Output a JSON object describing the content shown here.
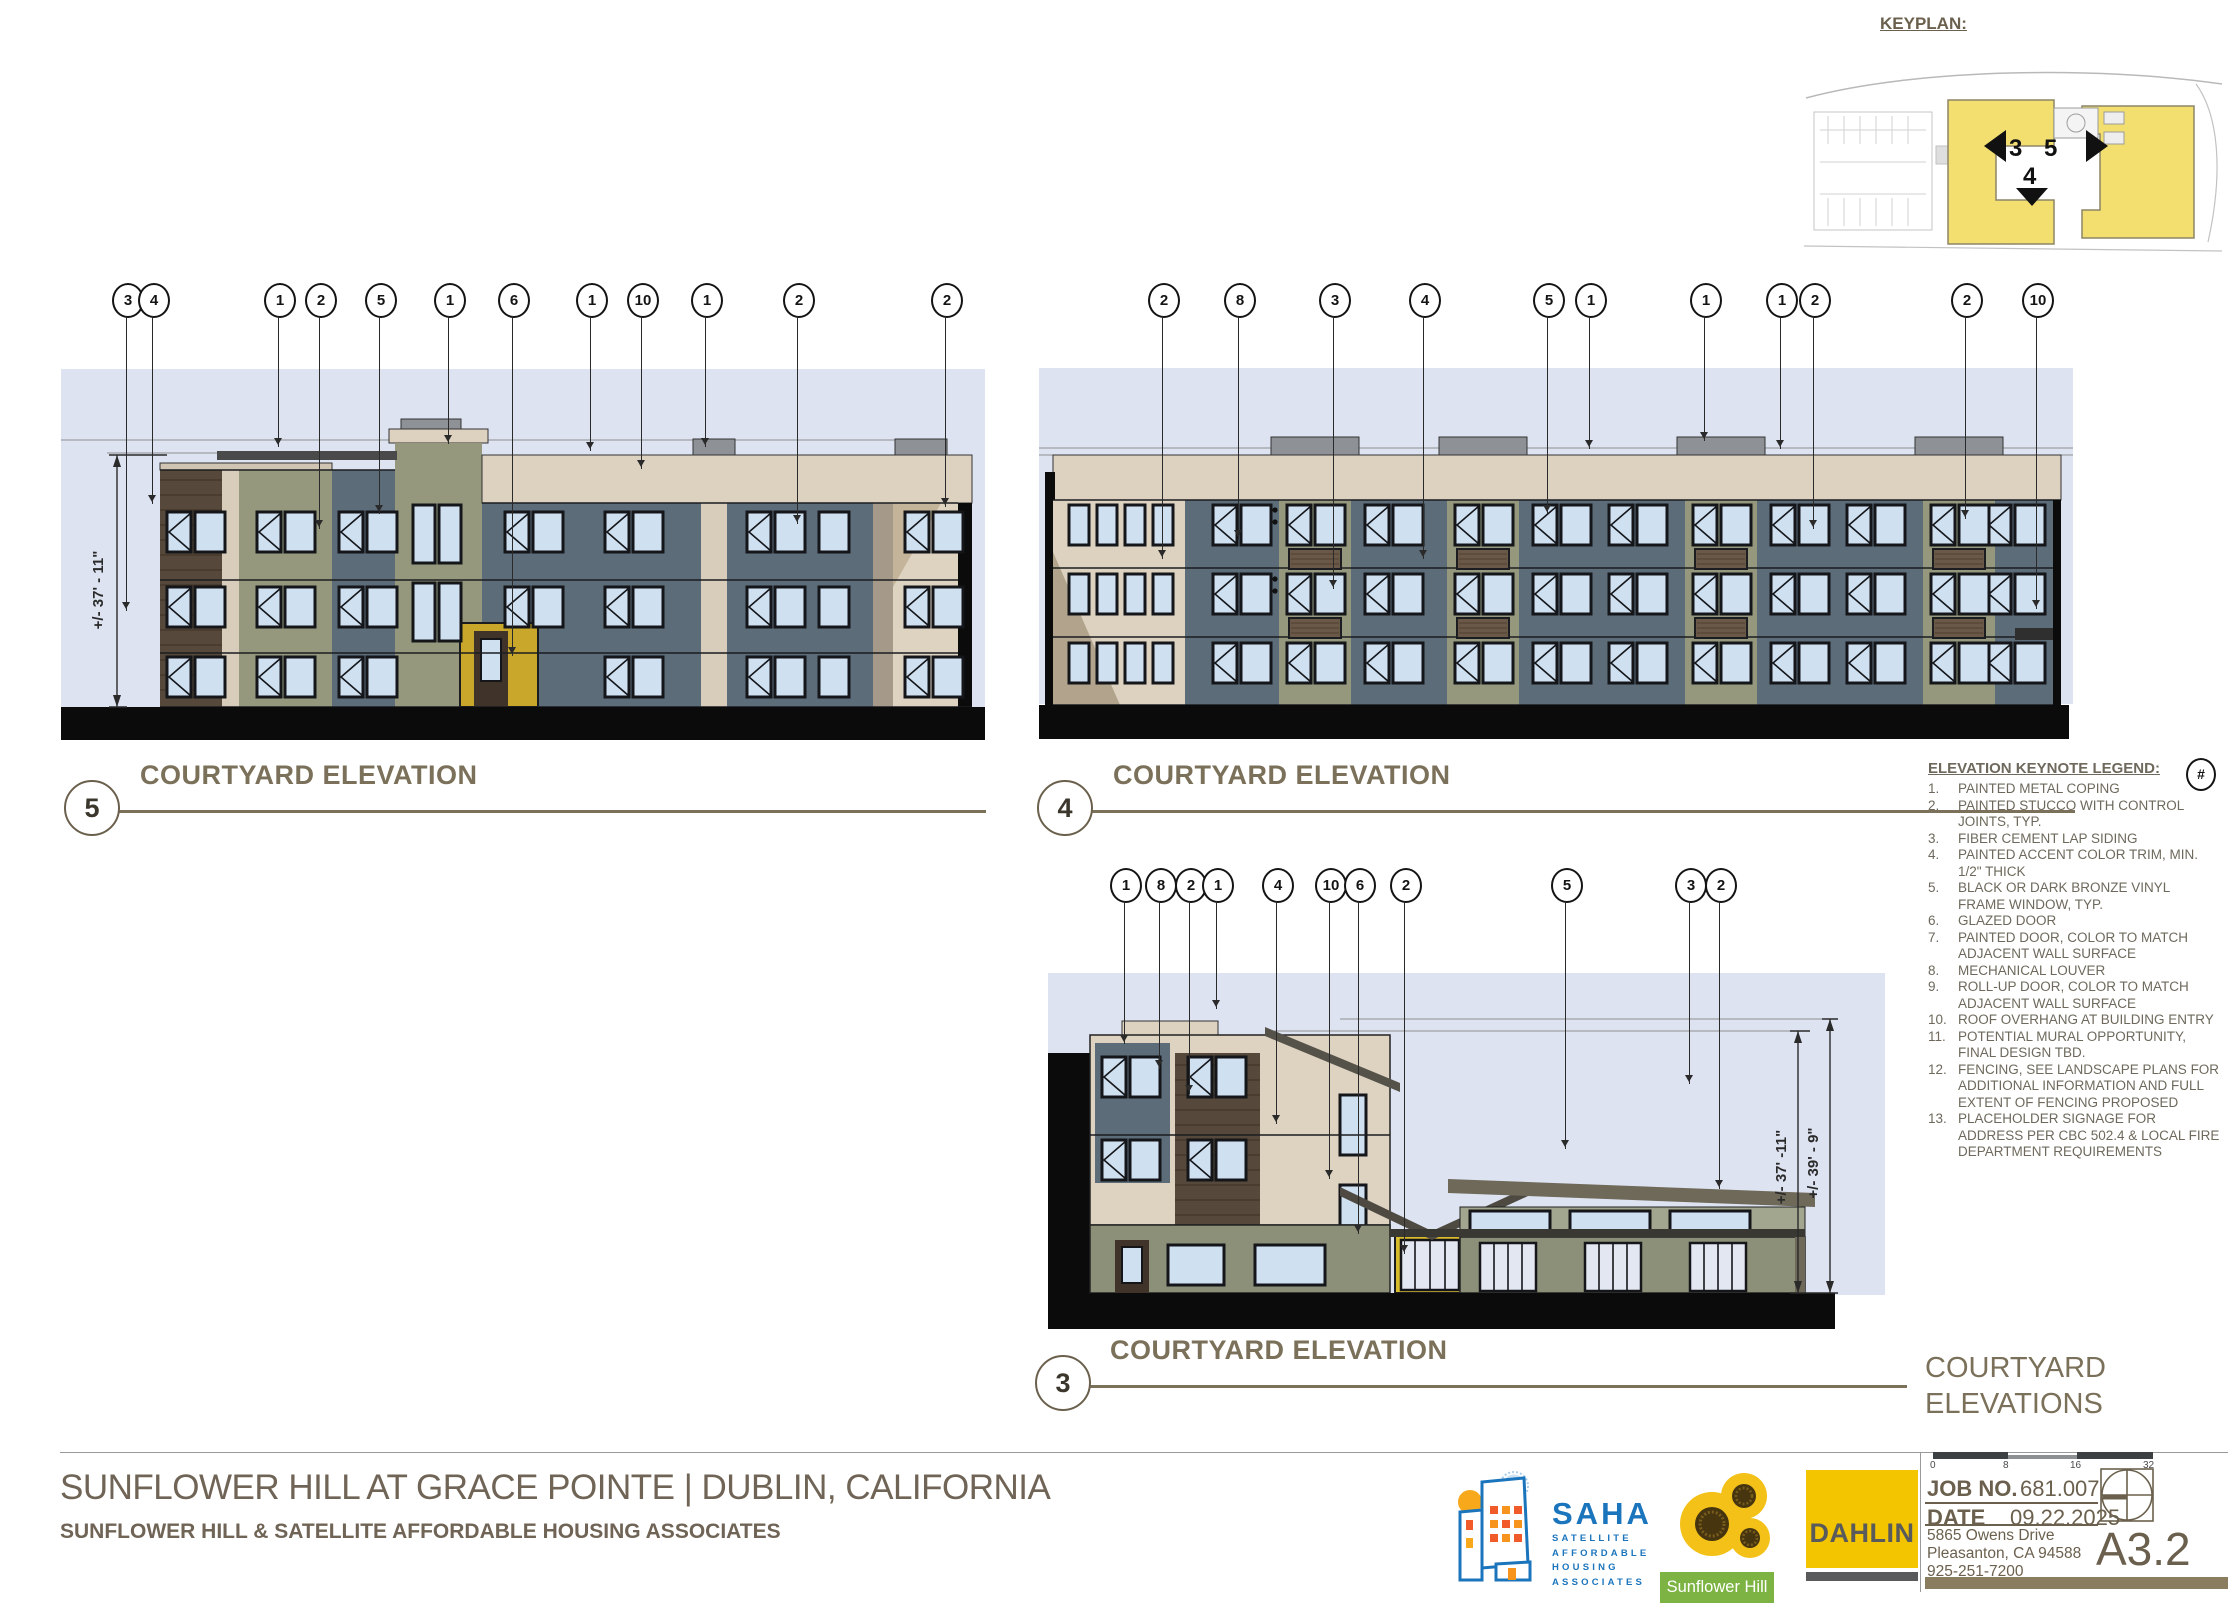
{
  "keyplan": {
    "label": "KEYPLAN:",
    "arrow_labels": [
      "3",
      "4",
      "5"
    ]
  },
  "elevations": [
    {
      "number": "5",
      "title": "COURTYARD ELEVATION",
      "callouts": [
        "3",
        "4",
        "1",
        "2",
        "5",
        "1",
        "6",
        "1",
        "10",
        "1",
        "2",
        "2"
      ],
      "dimensions": [
        "+/- 37' - 11\""
      ]
    },
    {
      "number": "4",
      "title": "COURTYARD ELEVATION",
      "callouts": [
        "2",
        "8",
        "3",
        "4",
        "5",
        "1",
        "1",
        "1",
        "2",
        "2",
        "10"
      ],
      "dimensions": []
    },
    {
      "number": "3",
      "title": "COURTYARD ELEVATION",
      "callouts": [
        "1",
        "8",
        "2",
        "1",
        "4",
        "10",
        "6",
        "2",
        "5",
        "3",
        "2"
      ],
      "dimensions": [
        "+/- 37' -11\"",
        "+/- 39' - 9\""
      ]
    }
  ],
  "legend": {
    "title": "ELEVATION KEYNOTE LEGEND:",
    "symbol": "#",
    "items": [
      {
        "num": "1.",
        "text": "PAINTED METAL COPING"
      },
      {
        "num": "2.",
        "text": "PAINTED STUCCO WITH CONTROL JOINTS, TYP."
      },
      {
        "num": "3.",
        "text": "FIBER CEMENT LAP SIDING"
      },
      {
        "num": "4.",
        "text": "PAINTED ACCENT COLOR TRIM, MIN. 1/2\" THICK"
      },
      {
        "num": "5.",
        "text": "BLACK OR DARK BRONZE VINYL FRAME WINDOW, TYP."
      },
      {
        "num": "6.",
        "text": "GLAZED DOOR"
      },
      {
        "num": "7.",
        "text": "PAINTED DOOR, COLOR TO MATCH ADJACENT WALL SURFACE"
      },
      {
        "num": "8.",
        "text": "MECHANICAL LOUVER"
      },
      {
        "num": "9.",
        "text": "ROLL-UP DOOR, COLOR TO MATCH ADJACENT WALL SURFACE"
      },
      {
        "num": "10.",
        "text": "ROOF OVERHANG AT BUILDING ENTRY"
      },
      {
        "num": "11.",
        "text": "POTENTIAL MURAL OPPORTUNITY, FINAL DESIGN TBD."
      },
      {
        "num": "12.",
        "text": "FENCING, SEE LANDSCAPE PLANS FOR ADDITIONAL INFORMATION AND FULL EXTENT OF FENCING PROPOSED"
      },
      {
        "num": "13.",
        "text": "PLACEHOLDER SIGNAGE FOR ADDRESS PER CBC 502.4 & LOCAL FIRE DEPARTMENT REQUIREMENTS"
      }
    ]
  },
  "sheet_info": {
    "sheet_title_line1": "COURTYARD",
    "sheet_title_line2": "ELEVATIONS",
    "job_no_label": "JOB NO.",
    "job_no": "681.007",
    "date_label": "DATE",
    "date": "09.22.2025",
    "address_lines": [
      "5865 Owens Drive",
      "Pleasanton, CA 94588",
      "925-251-7200"
    ],
    "sheet_number": "A3.2",
    "scale_ticks": [
      "0",
      "8",
      "16",
      "32"
    ]
  },
  "footer": {
    "project_title": "SUNFLOWER HILL AT GRACE POINTE  |  DUBLIN, CALIFORNIA",
    "client_line": "SUNFLOWER HILL & SATELLITE AFFORDABLE HOUSING ASSOCIATES"
  },
  "logos": {
    "saha": {
      "name": "SAHA",
      "subtitle_lines": [
        "SATELLITE",
        "AFFORDABLE",
        "HOUSING",
        "ASSOCIATES"
      ]
    },
    "sunflower_hill": {
      "name": "Sunflower Hill"
    },
    "dahlin": {
      "name": "DAHLIN"
    }
  },
  "colors": {
    "accent_brown": "#7b7059",
    "sky": "#dde3f1",
    "panel_bluegray": "#5d6c79",
    "stucco_green": "#95987c",
    "stucco_cream": "#ddd2c0",
    "wood_brown": "#56483a",
    "accent_yellow": "#c9a72a",
    "saha_blue": "#1b75bc",
    "sunflower_green": "#7cb342",
    "dahlin_yellow": "#f2c500",
    "keyplan_yellow": "#f2df6f"
  }
}
